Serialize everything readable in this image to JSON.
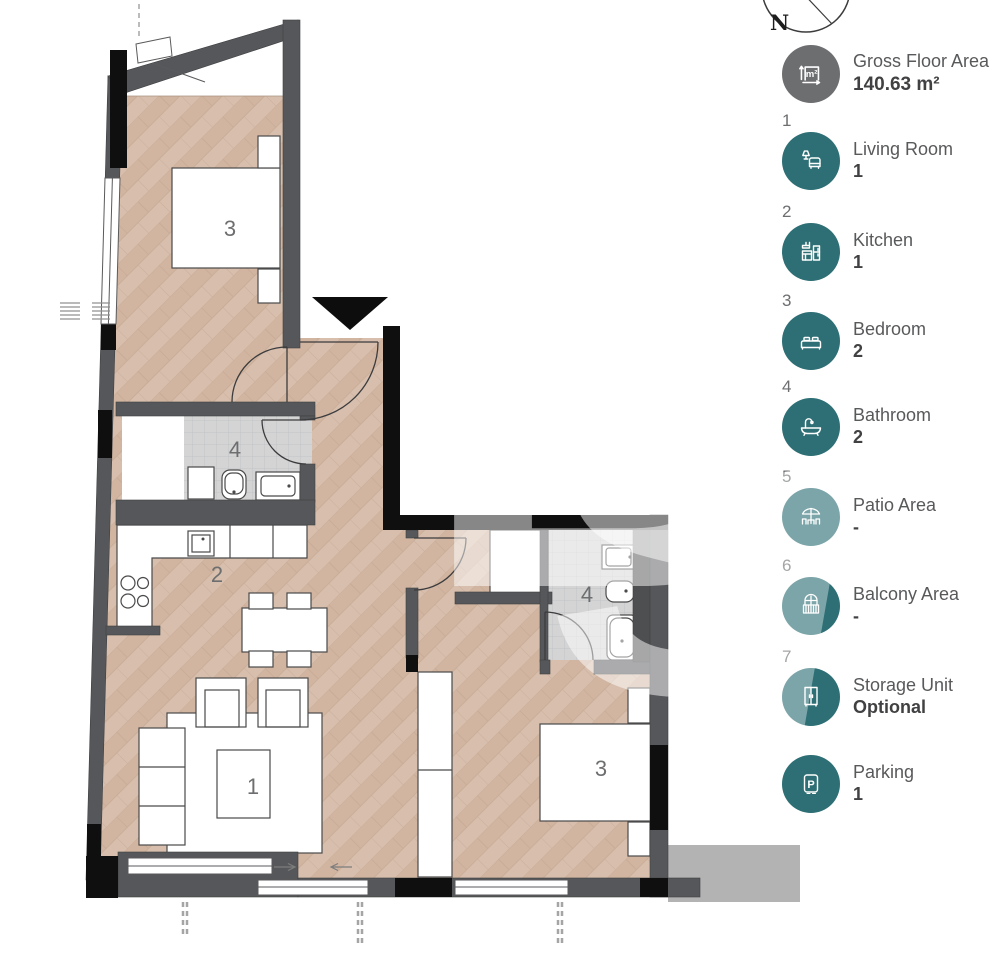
{
  "compass": {
    "north": "N"
  },
  "watermark": {
    "letters": [
      "B",
      "S"
    ]
  },
  "plan": {
    "room_labels": [
      {
        "id": "bedroom-top",
        "text": "3"
      },
      {
        "id": "bathroom-left",
        "text": "4"
      },
      {
        "id": "kitchen",
        "text": "2"
      },
      {
        "id": "living-room",
        "text": "1"
      },
      {
        "id": "bathroom-right",
        "text": "4"
      },
      {
        "id": "bedroom-right",
        "text": "3"
      }
    ]
  },
  "legend": {
    "gfa": {
      "label": "Gross Floor Area",
      "value": "140.63 m²",
      "icon_text": "m²"
    },
    "items": [
      {
        "num": "1",
        "label": "Living Room",
        "value": "1"
      },
      {
        "num": "2",
        "label": "Kitchen",
        "value": "1"
      },
      {
        "num": "3",
        "label": "Bedroom",
        "value": "2"
      },
      {
        "num": "4",
        "label": "Bathroom",
        "value": "2"
      },
      {
        "num": "5",
        "label": "Patio Area",
        "value": "-"
      },
      {
        "num": "6",
        "label": "Balcony Area",
        "value": "-"
      },
      {
        "num": "7",
        "label": "Storage Unit",
        "value": "Optional"
      },
      {
        "num": "",
        "label": "Parking",
        "value": "1",
        "icon_text": "P"
      }
    ],
    "colors": {
      "teal": "#2D6F75",
      "gray": "#6D6E70"
    }
  }
}
